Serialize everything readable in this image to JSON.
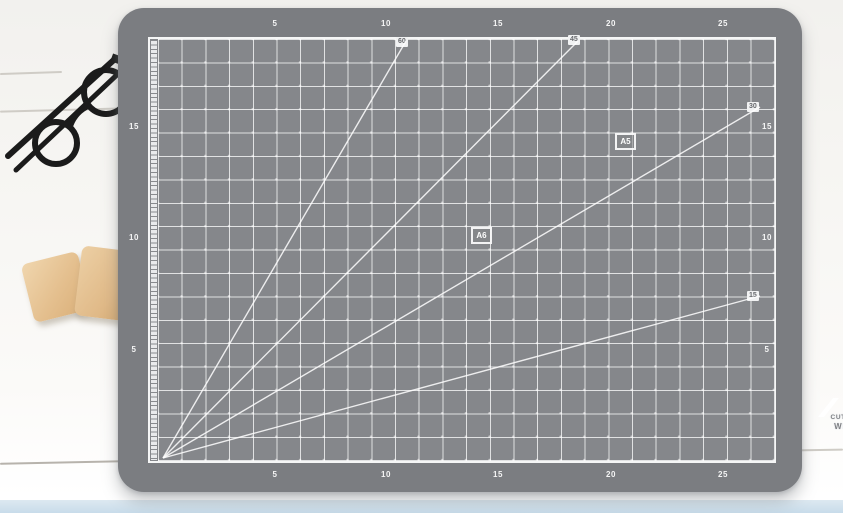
{
  "scene": {
    "description_objects": {
      "glasses": "black round folded glasses",
      "wood_blocks": "two tan wooden blocks",
      "table": "white wooden planks",
      "mat": "gray A4 cutting mat"
    },
    "colors": {
      "mat_border": "#7b7d81",
      "mat_surface": "#85878b",
      "grid_line": "#ffffff",
      "table_wood": "#f5f4f1",
      "bottom_strip_blue": "#cddfec",
      "block_tan": "#e4bf8e",
      "glasses_black": "#1b1b1b"
    }
  },
  "mat": {
    "top_numbers": [
      "5",
      "10",
      "15",
      "20",
      "25"
    ],
    "bottom_numbers": [
      "5",
      "10",
      "15",
      "20",
      "25"
    ],
    "left_numbers": [
      "15",
      "10",
      "5"
    ],
    "right_numbers": [
      "15",
      "10",
      "5"
    ],
    "angle_labels": [
      "60",
      "45",
      "30",
      "15"
    ],
    "size_labels": [
      "A5",
      "A6"
    ],
    "logo": {
      "size": "A4",
      "line1": "CUTTING MAT",
      "line2": "WINSTAR"
    }
  }
}
